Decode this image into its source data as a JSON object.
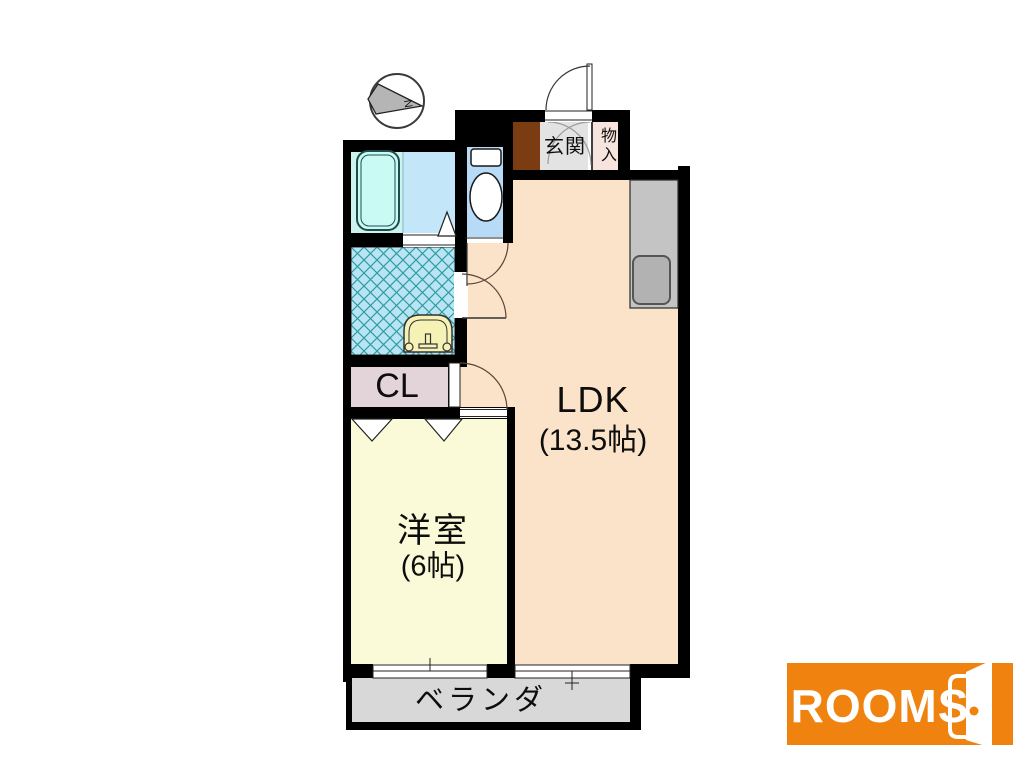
{
  "floorplan": {
    "rooms": {
      "ldk": {
        "label": "LDK",
        "size": "(13.5帖)"
      },
      "bedroom": {
        "label": "洋室",
        "size": "(6帖)"
      },
      "closet": {
        "label": "CL"
      },
      "entrance": {
        "label": "玄関"
      },
      "storage": {
        "label": "物入"
      },
      "veranda": {
        "label": "ベランダ"
      }
    },
    "compass": {
      "label": "N"
    },
    "colors": {
      "wall": "#000000",
      "ldk": "#fbe3c9",
      "bedroom": "#fafad8",
      "closet": "#e3d4d9",
      "entrance_tile": "#e3e3e3",
      "storage": "#f8e4df",
      "shoe_cabinet": "#7a3c10",
      "bath_floor": "#c3e6f8",
      "bath_wet_zone": "#ccf3ee",
      "tub": "#c9faf3",
      "toilet_room": "#b7daf7",
      "laundry": "#b9e4f5",
      "laundry_hatch": "#2f9d9c",
      "washer_pan": "#f6f2b5",
      "counter": "#c4c4c4",
      "sink": "#b2b2b2",
      "veranda": "#d8d8d8",
      "arrow_gray": "#b5b5b5"
    }
  },
  "logo": {
    "text": "ROOMS",
    "background": "#f0830f",
    "door_knob": "#f0830f"
  }
}
